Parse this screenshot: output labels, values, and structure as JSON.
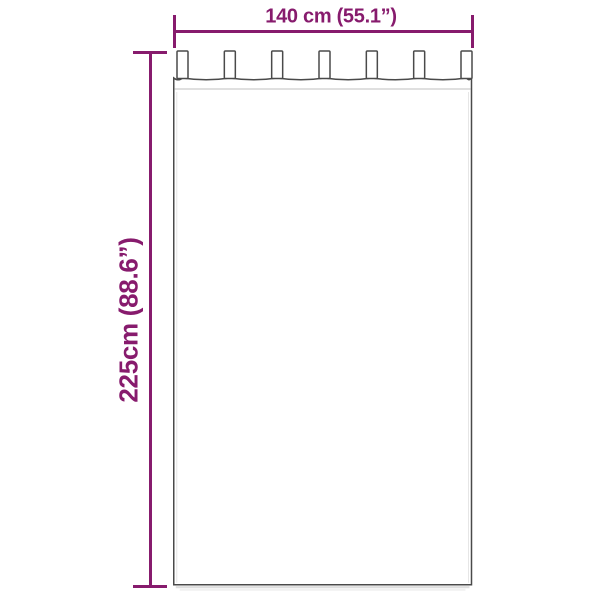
{
  "illustration": {
    "subject": "tab-top-curtain",
    "tab_count": 7
  },
  "dimensions": {
    "width": {
      "label": "140 cm (55.1”)",
      "value_cm": 140,
      "value_in": 55.1
    },
    "height": {
      "label": "225cm (88.6”)",
      "value_cm": 225,
      "value_in": 88.6
    }
  },
  "colors": {
    "background": "#ffffff",
    "accent": "#871b6d",
    "outline": "#4a4a4a",
    "seam": "#cccccc",
    "fabric": "#ffffff",
    "shadow": "#bfbfbf"
  }
}
